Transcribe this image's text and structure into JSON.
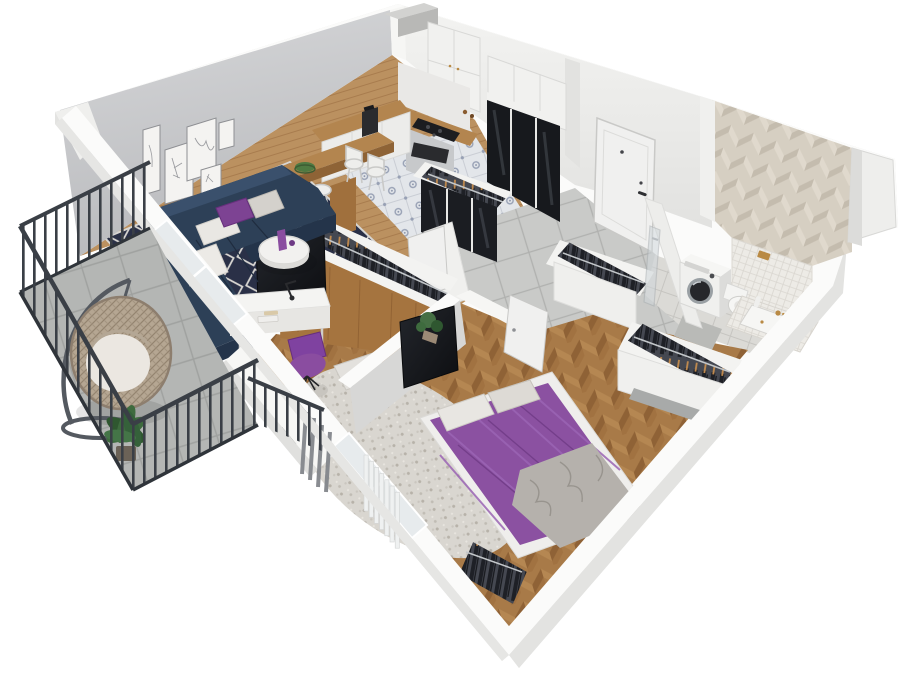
{
  "scene": {
    "title": "3D isometric apartment floor plan render",
    "view": "dollhouse cutaway, viewed from above at an angle",
    "background": "#ffffff",
    "rooms": [
      {
        "name": "living-room",
        "items": [
          "gallery-wall-5-frames",
          "corner-sofa-navy",
          "white-pillows",
          "purple-pillow",
          "round-coffee-table",
          "purple-vase",
          "diamond-pattern-rug",
          "tv-panel",
          "curtains",
          "balcony-door"
        ],
        "frame_count": 5,
        "sofa_pillow_count": 4
      },
      {
        "name": "kitchen",
        "items": [
          "upper-cabinets",
          "tall-cabinet-column",
          "black-glass-unit",
          "stove-cooktop",
          "oven",
          "coffee-maker",
          "wood-counter",
          "breakfast-bar",
          "bar-stools",
          "ornamental-tile-floor"
        ],
        "bar_stool_count": 4
      },
      {
        "name": "hallway",
        "items": [
          "entrance-door",
          "open-door-leaves",
          "built-in-closet-black-glass",
          "closet-with-hangers",
          "large-tile-floor",
          "shaft-niche"
        ]
      },
      {
        "name": "bathroom",
        "items": [
          "herringbone-accent-wall",
          "washing-machine",
          "toilet",
          "bathtub-mosaic-apron",
          "brass-fixtures",
          "glass-shower-panel",
          "light-tile-floor"
        ]
      },
      {
        "name": "bedroom",
        "items": [
          "double-bed-purple-duvet",
          "bed-pillows",
          "gray-throw-blanket",
          "tv-partition-wall",
          "wall-mounted-tv",
          "white-desk",
          "desk-lamp",
          "books",
          "purple-shell-chair",
          "shaggy-rug",
          "floor-cushions",
          "open-wardrobe-with-hangers",
          "clothes-racks",
          "radiator",
          "window",
          "potted-plant",
          "open-door"
        ],
        "bed_pillow_count": 2
      },
      {
        "name": "balcony",
        "items": [
          "dark-metal-railing",
          "hanging-egg-chair",
          "chair-stand",
          "potted-plant",
          "concrete-tile-floor",
          "french-balcony-rail"
        ]
      }
    ],
    "palette": {
      "wallWhite": "#f2f2f0",
      "wallShade": "#e0e0de",
      "wallTop": "#fbfbfa",
      "wallFace": "#e9e9e7",
      "accentWall": "#c6c7c9",
      "pillar": "#f6f6f4",
      "floorWood": "#bb9160",
      "woodTop": "#b3854f",
      "woodSide": "#8e6336",
      "closetWood": "#a5743f",
      "sofa": "#2d4057",
      "sofaDark": "#24344a",
      "sofaLight": "#3a506c",
      "pillowWhite": "#e9e7e3",
      "pillowGray": "#d4d1cc",
      "pillowPurple": "#7d4393",
      "bedPurple": "#8b51a1",
      "bedPurpleDark": "#6e3a85",
      "bedFold": "#9a64b4",
      "blanketGray": "#b5b1ac",
      "chairPurple": "#7f42a0",
      "vasePurple": "#8a4da0",
      "tvBlack": "#141619",
      "blackGlass": "#17191d",
      "railing": "#3a3f46",
      "concrete": "#b4b6b4",
      "rattan": "#b5a692",
      "plantGreen": "#3e6b3e",
      "washer": "#f0f0ee",
      "brass": "#b98a44",
      "chrome": "#b9bec2",
      "clothesDark": "#202229",
      "clothesBg": "#454851",
      "hangerTan": "#c28b4e",
      "doorWhite": "#f0f0ef",
      "curtain": "#83868b",
      "radiator": "#eff1f1",
      "shagRug": "#d9d6d0",
      "rugNavy": "#2a3047",
      "rugLattice": "#d8d6d2",
      "herringTan": "#d6cfc2",
      "mosaic": "#edebe6",
      "bathFloor": "#dbdad6",
      "kitchenTile": "#e3e6ea",
      "kitchenMotif": "#97a0b4",
      "hallTile": "#c9cac8"
    }
  }
}
